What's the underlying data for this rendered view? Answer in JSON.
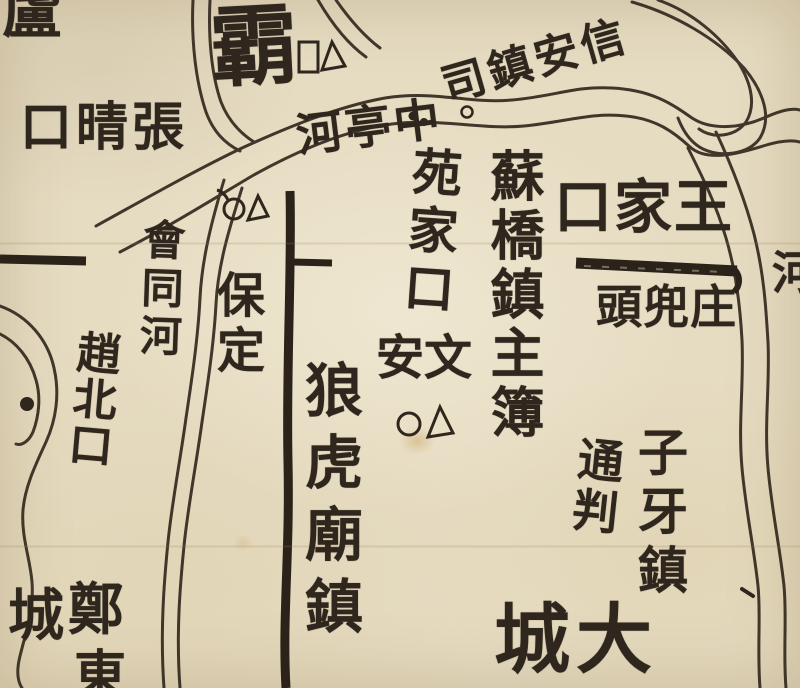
{
  "map": {
    "kind": "historical woodblock-printed Chinese map (river and dike detail)",
    "colors": {
      "paper": "#e6dcc2",
      "ink": "#30281e"
    },
    "labels": {
      "lu_partial": {
        "text": "盧",
        "note_kind": "partial character clipped at top edge"
      },
      "zhang_qing_kou": {
        "text": "張晴口",
        "orientation": "horizontal-rtl"
      },
      "ba_zhou": {
        "text": "霸",
        "orientation": "single large character"
      },
      "xin_an_zhen_si": {
        "text": "信安鎮司",
        "orientation": "horizontal-rtl diagonal"
      },
      "zhong_ting_he": {
        "text": "中亭河",
        "orientation": "horizontal-rtl"
      },
      "yuan_jia_kou": {
        "text": "苑家口",
        "orientation": "vertical"
      },
      "su_qiao_zhen_zhu_bu": {
        "text": "蘇橋鎮主簿",
        "orientation": "vertical"
      },
      "wang_jia_kou": {
        "text": "王家口",
        "orientation": "horizontal-rtl"
      },
      "zhuang_dou_tou": {
        "text": "庄兜頭",
        "orientation": "horizontal-rtl"
      },
      "he_partial": {
        "text": "河",
        "note_kind": "partial character clipped at right edge"
      },
      "hui_tong_he": {
        "text": "會同河",
        "orientation": "vertical"
      },
      "bao_ding": {
        "text": "保定",
        "orientation": "vertical"
      },
      "zhao_bei_kou": {
        "text": "趙北口",
        "orientation": "vertical"
      },
      "wen_an": {
        "text": "文安",
        "orientation": "horizontal-rtl"
      },
      "lang_hu_miao_zhen": {
        "text": "狼虎廟鎮",
        "orientation": "vertical"
      },
      "zi_ya_zhen": {
        "text": "子牙鎮",
        "orientation": "vertical"
      },
      "tong_pan": {
        "text": "通判",
        "orientation": "vertical"
      },
      "da_cheng": {
        "text": "大城",
        "orientation": "horizontal-rtl"
      },
      "zheng": {
        "text": "鄭"
      },
      "dong_partial": {
        "text": "東",
        "note_kind": "partial character clipped at bottom edge"
      },
      "cheng": {
        "text": "城"
      }
    },
    "symbols": {
      "ba_zhou_marker": {
        "shapes": "□ △",
        "near": "霸"
      },
      "bao_ding_marker": {
        "shapes": "○ △",
        "near": "保定"
      },
      "wen_an_marker": {
        "shapes": "○ △",
        "near": "文安"
      },
      "village_dot_open": {
        "shapes": "◦",
        "near": "中亭河"
      },
      "village_dots_filled": {
        "shapes": "● ●",
        "near": "中亭河 west"
      },
      "lake_island_dot": {
        "shapes": "●",
        "near": "southwest lake"
      }
    },
    "features": {
      "rivers": "double-line engraved watercourses",
      "dikes": "three heavy black bars (embankments)"
    }
  }
}
